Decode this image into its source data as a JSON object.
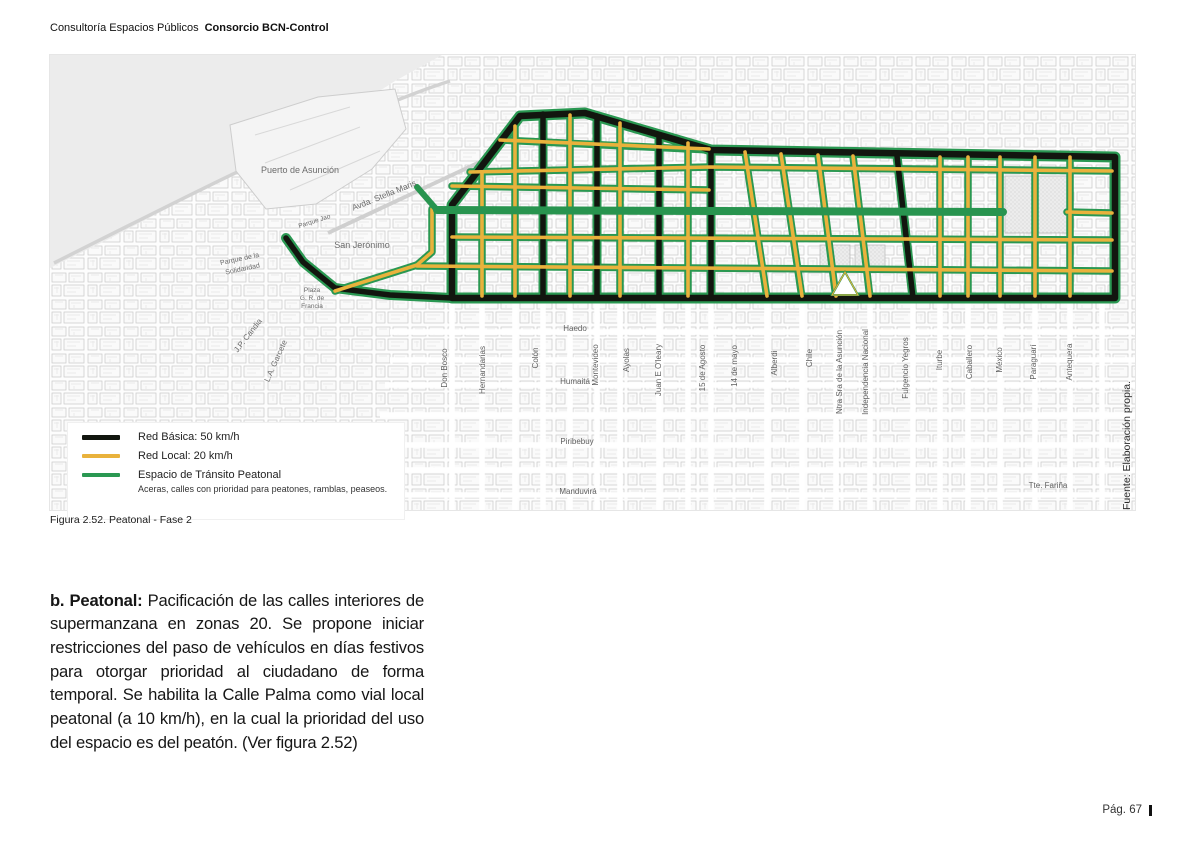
{
  "header": {
    "title_regular": "Consultoría Espacios Públicos",
    "title_bold": "Consorcio BCN-Control"
  },
  "colors": {
    "road_basica": "#12160f",
    "road_local": "#e9b23c",
    "road_peatonal": "#2a9852"
  },
  "figure": {
    "caption": "Figura 2.52. Peatonal - Fase 2",
    "source_note": "Fuente: Elaboración propia.",
    "legend": {
      "items": [
        {
          "label": "Red Básica: 50 km/h",
          "color": "#12160f",
          "thick": 5
        },
        {
          "label": "Red Local: 20 km/h",
          "color": "#e9b23c",
          "thick": 4
        },
        {
          "label": "Espacio de Tránsito Peatonal",
          "color": "#2a9852",
          "thick": 4,
          "sublabel": "Aceras, calles con prioridad para peatones, ramblas, peaseos."
        }
      ]
    },
    "map": {
      "vertical_streets": [
        {
          "t": "Don Bosco",
          "x": 397,
          "y": 313
        },
        {
          "t": "Hernandarias",
          "x": 435,
          "y": 315
        },
        {
          "t": "Colón",
          "x": 488,
          "y": 303
        },
        {
          "t": "Montevideo",
          "x": 548,
          "y": 310
        },
        {
          "t": "Ayolas",
          "x": 579,
          "y": 305
        },
        {
          "t": "Juan E O'leary",
          "x": 611,
          "y": 315
        },
        {
          "t": "15 de Agosto",
          "x": 655,
          "y": 313
        },
        {
          "t": "14 de mayo",
          "x": 687,
          "y": 311
        },
        {
          "t": "Alberdi",
          "x": 727,
          "y": 308
        },
        {
          "t": "Chile",
          "x": 762,
          "y": 303
        },
        {
          "t": "Ntra Sra de la Asunción",
          "x": 792,
          "y": 317
        },
        {
          "t": "Independencia Nacional",
          "x": 818,
          "y": 317
        },
        {
          "t": "Fulgencio Yegros",
          "x": 858,
          "y": 313
        },
        {
          "t": "Iturbe",
          "x": 892,
          "y": 305
        },
        {
          "t": "Caballero",
          "x": 922,
          "y": 307
        },
        {
          "t": "México",
          "x": 952,
          "y": 305
        },
        {
          "t": "Paraguarí",
          "x": 986,
          "y": 307
        },
        {
          "t": "Antequera",
          "x": 1022,
          "y": 307
        }
      ],
      "horizontal_streets": [
        {
          "t": "Haedo",
          "x": 525,
          "y": 276
        },
        {
          "t": "Humaitá",
          "x": 525,
          "y": 329
        },
        {
          "t": "Piribebuy",
          "x": 527,
          "y": 389
        },
        {
          "t": "Manduvirá",
          "x": 528,
          "y": 439
        },
        {
          "t": "Tte. Fariña",
          "x": 998,
          "y": 433
        }
      ],
      "areas": [
        {
          "t": "Puerto de Asunción",
          "x": 250,
          "y": 118,
          "s": 9
        },
        {
          "t": "San Jerónimo",
          "x": 312,
          "y": 193,
          "s": 9
        },
        {
          "t": "Avda. Stella Maris",
          "x": 335,
          "y": 143,
          "r": -22,
          "s": 8.5
        },
        {
          "t": "Parque de la",
          "x": 190,
          "y": 206,
          "r": -12,
          "s": 7
        },
        {
          "t": "Solidaridad",
          "x": 193,
          "y": 216,
          "r": -12,
          "s": 7
        },
        {
          "t": "Parque Jao",
          "x": 265,
          "y": 168,
          "r": -18,
          "s": 6.5
        },
        {
          "t": "Plaza",
          "x": 262,
          "y": 237,
          "s": 6.5
        },
        {
          "t": "G. R. de",
          "x": 262,
          "y": 245,
          "s": 6.5
        },
        {
          "t": "Francia",
          "x": 262,
          "y": 253,
          "s": 6.5
        },
        {
          "t": "J.P. Candia",
          "x": 200,
          "y": 282,
          "r": -52,
          "s": 8
        },
        {
          "t": "L.A. Garcete",
          "x": 228,
          "y": 307,
          "r": -66,
          "s": 8
        }
      ]
    }
  },
  "body": {
    "lead": "b. Peatonal:",
    "text": "Pacificación de las calles interiores de supermanzana en zonas 20. Se propone iniciar restricciones del paso de vehículos en días festivos para otorgar prioridad al ciudadano de forma temporal. Se habilita la Calle Palma como vial local peatonal (a 10 km/h), en la cual la prioridad del uso del espacio es del peatón. (Ver figura 2.52)"
  },
  "footer": {
    "page": "Pág. 67"
  }
}
